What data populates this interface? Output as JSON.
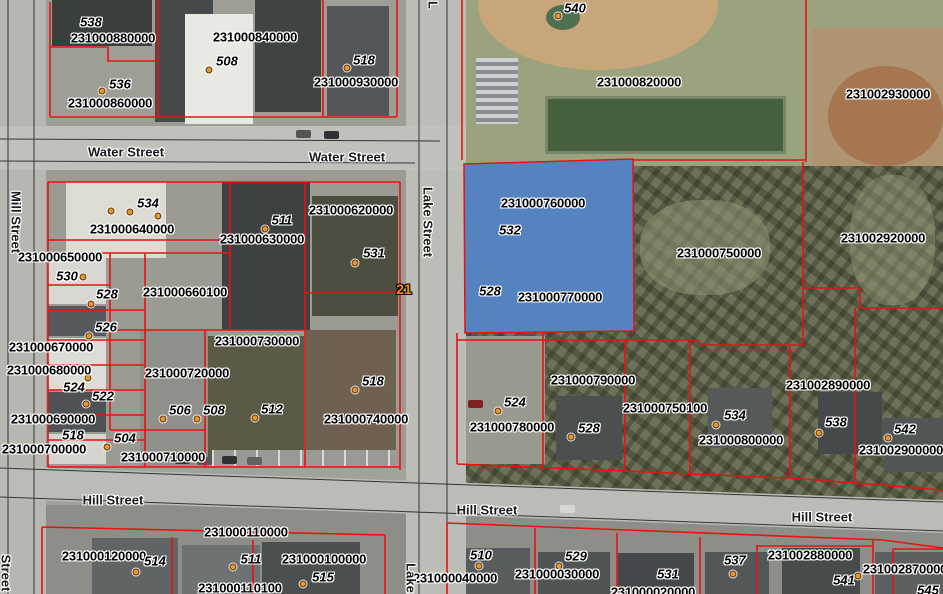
{
  "map": {
    "highlight_color": "#5583bf",
    "parcel_line_color": "#e81212",
    "street_line_color": "#1c1c1c",
    "address_dot_color": "#dd9933",
    "route_marker": {
      "text": "21",
      "x": 404,
      "y": 289,
      "color": "#ff9100"
    },
    "selected_parcel_ids": [
      "231000760000",
      "231000770000"
    ],
    "parcel_labels": [
      {
        "id": "231000880000",
        "x": 113,
        "y": 38
      },
      {
        "id": "231000840000",
        "x": 255,
        "y": 37
      },
      {
        "id": "231000930000",
        "x": 356,
        "y": 82
      },
      {
        "id": "231000860000",
        "x": 110,
        "y": 103
      },
      {
        "id": "231000820000",
        "x": 639,
        "y": 82
      },
      {
        "id": "231002930000",
        "x": 888,
        "y": 94
      },
      {
        "id": "231000620000",
        "x": 351,
        "y": 210
      },
      {
        "id": "231000640000",
        "x": 132,
        "y": 229
      },
      {
        "id": "231000630000",
        "x": 262,
        "y": 239
      },
      {
        "id": "231000650000",
        "x": 60,
        "y": 257
      },
      {
        "id": "231000660100",
        "x": 185,
        "y": 292
      },
      {
        "id": "231000670000",
        "x": 51,
        "y": 347
      },
      {
        "id": "231000680000",
        "x": 49,
        "y": 370
      },
      {
        "id": "231000720000",
        "x": 187,
        "y": 373
      },
      {
        "id": "231000730000",
        "x": 257,
        "y": 341
      },
      {
        "id": "231000690000",
        "x": 53,
        "y": 419
      },
      {
        "id": "231000740000",
        "x": 366,
        "y": 419
      },
      {
        "id": "231000700000",
        "x": 44,
        "y": 449
      },
      {
        "id": "231000710000",
        "x": 163,
        "y": 457
      },
      {
        "id": "231000760000",
        "x": 543,
        "y": 203
      },
      {
        "id": "231000770000",
        "x": 560,
        "y": 297
      },
      {
        "id": "231000750000",
        "x": 719,
        "y": 253
      },
      {
        "id": "231002920000",
        "x": 883,
        "y": 238
      },
      {
        "id": "231000790000",
        "x": 593,
        "y": 380
      },
      {
        "id": "231000750100",
        "x": 665,
        "y": 408
      },
      {
        "id": "231000780000",
        "x": 512,
        "y": 427
      },
      {
        "id": "231002890000",
        "x": 828,
        "y": 385
      },
      {
        "id": "231000800000",
        "x": 741,
        "y": 440
      },
      {
        "id": "231002900000",
        "x": 901,
        "y": 450
      },
      {
        "id": "231000110000",
        "x": 246,
        "y": 532
      },
      {
        "id": "231000120000",
        "x": 104,
        "y": 556
      },
      {
        "id": "231000100000",
        "x": 324,
        "y": 559
      },
      {
        "id": "231000110100",
        "x": 240,
        "y": 588
      },
      {
        "id": "231000040000",
        "x": 455,
        "y": 578
      },
      {
        "id": "231000030000",
        "x": 557,
        "y": 574
      },
      {
        "id": "231000020000",
        "x": 653,
        "y": 592
      },
      {
        "id": "231002880000",
        "x": 810,
        "y": 555
      },
      {
        "id": "231002870000",
        "x": 905,
        "y": 569
      }
    ],
    "address_labels": [
      {
        "num": "538",
        "x": 91,
        "y": 22
      },
      {
        "num": "536",
        "x": 120,
        "y": 84
      },
      {
        "num": "508",
        "x": 227,
        "y": 61
      },
      {
        "num": "518",
        "x": 364,
        "y": 60
      },
      {
        "num": "540",
        "x": 575,
        "y": 8
      },
      {
        "num": "534",
        "x": 148,
        "y": 203
      },
      {
        "num": "530",
        "x": 67,
        "y": 276
      },
      {
        "num": "528",
        "x": 107,
        "y": 294
      },
      {
        "num": "526",
        "x": 106,
        "y": 327
      },
      {
        "num": "524",
        "x": 74,
        "y": 387
      },
      {
        "num": "522",
        "x": 103,
        "y": 396
      },
      {
        "num": "518",
        "x": 73,
        "y": 435
      },
      {
        "num": "504",
        "x": 125,
        "y": 438
      },
      {
        "num": "506",
        "x": 180,
        "y": 410
      },
      {
        "num": "508",
        "x": 214,
        "y": 410
      },
      {
        "num": "511",
        "x": 282,
        "y": 220
      },
      {
        "num": "531",
        "x": 374,
        "y": 253
      },
      {
        "num": "512",
        "x": 272,
        "y": 409
      },
      {
        "num": "518",
        "x": 373,
        "y": 381
      },
      {
        "num": "532",
        "x": 510,
        "y": 230
      },
      {
        "num": "528",
        "x": 490,
        "y": 291
      },
      {
        "num": "524",
        "x": 515,
        "y": 402
      },
      {
        "num": "528",
        "x": 589,
        "y": 428
      },
      {
        "num": "534",
        "x": 735,
        "y": 415
      },
      {
        "num": "538",
        "x": 836,
        "y": 422
      },
      {
        "num": "542",
        "x": 905,
        "y": 429
      },
      {
        "num": "514",
        "x": 155,
        "y": 561
      },
      {
        "num": "511",
        "x": 251,
        "y": 559
      },
      {
        "num": "515",
        "x": 323,
        "y": 577
      },
      {
        "num": "510",
        "x": 481,
        "y": 555
      },
      {
        "num": "529",
        "x": 576,
        "y": 556
      },
      {
        "num": "531",
        "x": 668,
        "y": 574
      },
      {
        "num": "537",
        "x": 735,
        "y": 560
      },
      {
        "num": "541",
        "x": 844,
        "y": 580
      },
      {
        "num": "545",
        "x": 928,
        "y": 590
      }
    ],
    "street_labels": [
      {
        "text": "Water Street",
        "x": 126,
        "y": 152,
        "rot": 0
      },
      {
        "text": "Water Street",
        "x": 347,
        "y": 157,
        "rot": 0
      },
      {
        "text": "Mill Street",
        "x": 16,
        "y": 222,
        "rot": 90
      },
      {
        "text": "Lake Street",
        "x": 428,
        "y": 222,
        "rot": 90
      },
      {
        "text": "Hill Street",
        "x": 113,
        "y": 500,
        "rot": 0
      },
      {
        "text": "Hill Street",
        "x": 487,
        "y": 510,
        "rot": 0
      },
      {
        "text": "Hill Street",
        "x": 822,
        "y": 517,
        "rot": 0
      },
      {
        "text": "Street",
        "x": 6,
        "y": 573,
        "rot": 90
      },
      {
        "text": "Lake",
        "x": 411,
        "y": 578,
        "rot": 90
      },
      {
        "text": "L",
        "x": 433,
        "y": 5,
        "rot": 90
      }
    ],
    "address_dots": [
      [
        102,
        91
      ],
      [
        209,
        70
      ],
      [
        347,
        68
      ],
      [
        558,
        16
      ],
      [
        111,
        211
      ],
      [
        130,
        212
      ],
      [
        158,
        216
      ],
      [
        83,
        277
      ],
      [
        91,
        304
      ],
      [
        89,
        336
      ],
      [
        88,
        378
      ],
      [
        86,
        404
      ],
      [
        107,
        447
      ],
      [
        163,
        419
      ],
      [
        197,
        419
      ],
      [
        265,
        229
      ],
      [
        355,
        263
      ],
      [
        255,
        418
      ],
      [
        355,
        390
      ],
      [
        498,
        411
      ],
      [
        571,
        437
      ],
      [
        716,
        425
      ],
      [
        819,
        433
      ],
      [
        888,
        438
      ],
      [
        136,
        572
      ],
      [
        233,
        567
      ],
      [
        303,
        584
      ],
      [
        479,
        566
      ],
      [
        559,
        566
      ],
      [
        733,
        574
      ],
      [
        858,
        576
      ]
    ]
  }
}
